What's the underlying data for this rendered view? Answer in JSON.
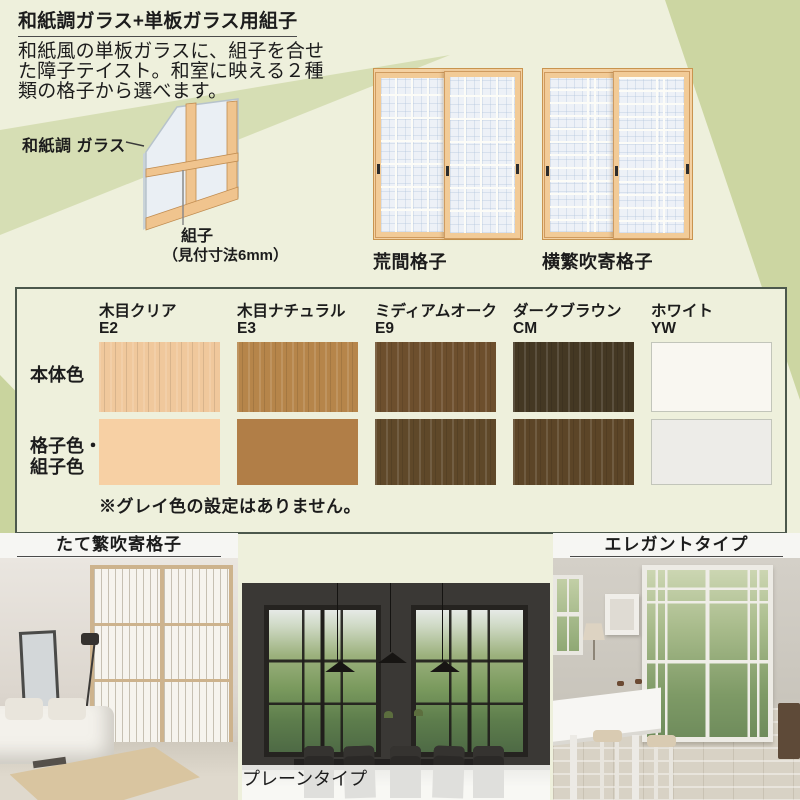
{
  "colors": {
    "background": "#eef0dc",
    "band_upper_left": "#d6deb4",
    "band_right": "#ccd6a2",
    "band_lower_left": "#c9d49e",
    "table_border": "#4c584c",
    "wood_frame": "#f4d1a2"
  },
  "intro": {
    "title": "和紙調ガラス+単板ガラス用組子",
    "description_lines": [
      "和紙風の単板ガラスに、組子を合せ",
      "た障子テイスト。和室に映える２種",
      "類の格子から選べます。"
    ]
  },
  "diagram": {
    "glass_label": "和紙調 ガラス",
    "kumiko_label": "組子",
    "kumiko_spec": "（見付寸法6mm）"
  },
  "lattice_types": [
    {
      "name": "荒間格子"
    },
    {
      "name": "横繁吹寄格子"
    }
  ],
  "color_table": {
    "row1_label": "本体色",
    "row2_label_line1": "格子色・",
    "row2_label_line2": "組子色",
    "note": "※グレイ色の設定はありません。",
    "columns": [
      {
        "name": "木目クリア",
        "code": "E2",
        "body": "#f0c89c",
        "grid": "#f7d0a4"
      },
      {
        "name": "木目ナチュラル",
        "code": "E3",
        "body": "#b6854a",
        "grid": "#b17e47"
      },
      {
        "name": "ミディアムオーク",
        "code": "E9",
        "body": "#6d4f2d",
        "grid": "#5f4829"
      },
      {
        "name": "ダークブラウン",
        "code": "CM",
        "body": "#443823",
        "grid": "#5c4527"
      },
      {
        "name": "ホワイト",
        "code": "YW",
        "body": "#f9f7f1",
        "grid": "#edece8"
      }
    ]
  },
  "photos": [
    {
      "label": "たて繁吹寄格子"
    },
    {
      "label": "プレーンタイプ"
    },
    {
      "label": "エレガントタイプ"
    }
  ]
}
